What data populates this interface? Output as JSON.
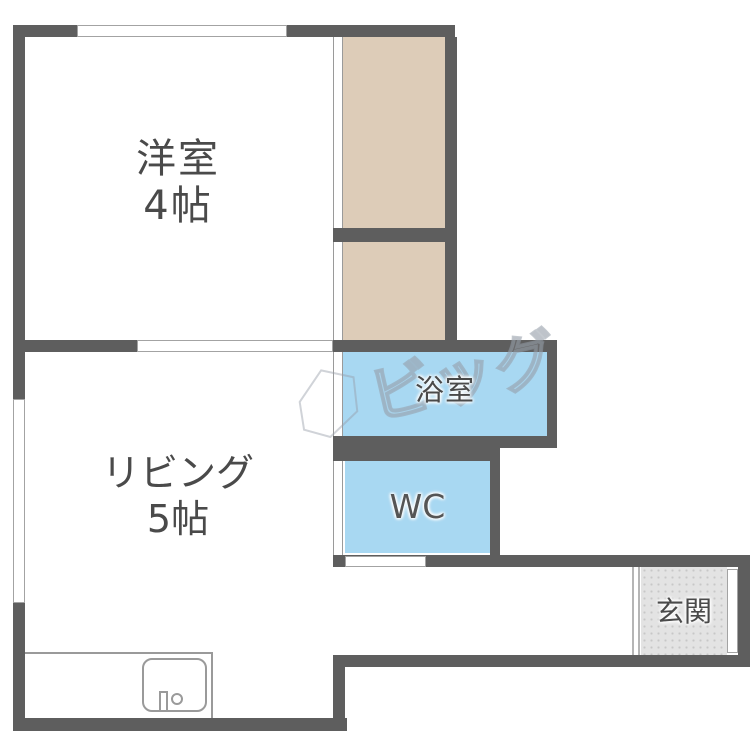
{
  "floorplan": {
    "type": "japanese-apartment-floorplan",
    "rooms": {
      "western_room": {
        "name": "洋室",
        "size": "4帖"
      },
      "living": {
        "name": "リビング",
        "size": "5帖"
      },
      "bath": {
        "name": "浴室"
      },
      "wc": {
        "name": "WC"
      },
      "genkan": {
        "name": "玄関"
      }
    },
    "fixtures": {
      "kitchen_sink": "kitchen counter with sink and faucet",
      "closet": "closet (2 sections, tan fill)",
      "windows": "top wall window, left wall window",
      "doors": "room sliding door, hallway door, front entrance door"
    },
    "watermark": {
      "text": "ビッグ"
    },
    "colors": {
      "wall": "#5e5e5e",
      "closet_fill": "#ddccb8",
      "water_fill": "#a8d8f2",
      "genkan_fill": "#e3e3e3",
      "label_text": "#4a4a4a",
      "thin_line": "#9a9a9a"
    }
  }
}
